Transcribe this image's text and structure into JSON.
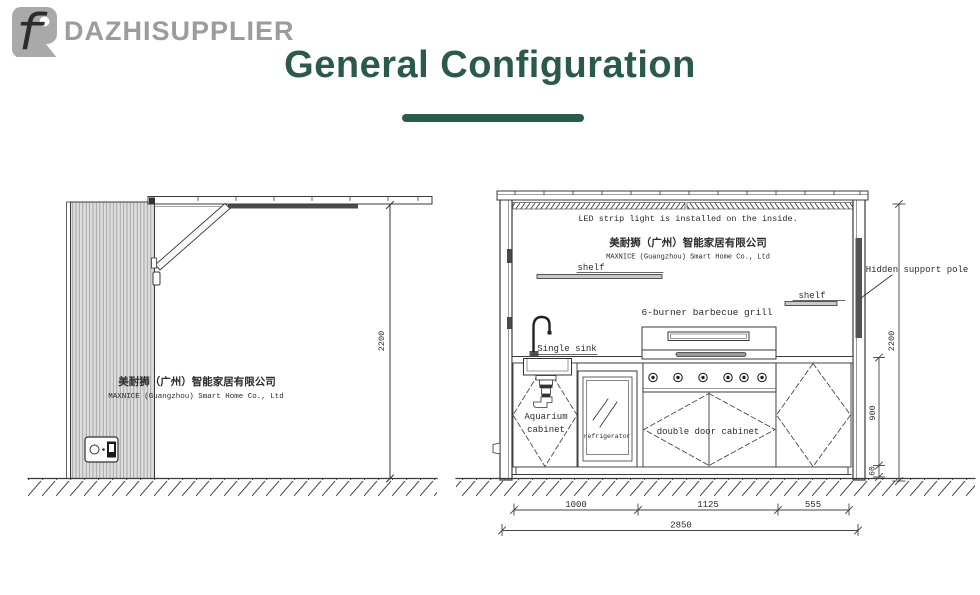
{
  "brand": {
    "name": "DAZHISUPPLIER",
    "monogram": "f"
  },
  "title": "General Configuration",
  "colors": {
    "accent_green": "#2a5b49",
    "logo_gray": "#9c9c9c",
    "line": "#3a3a3a"
  },
  "side_view": {
    "company_zh": "美耐狮（广州）智能家居有限公司",
    "company_en": "MAXNICE (Guangzhou) Smart Home Co., Ltd",
    "height_dim": "2200"
  },
  "front_view": {
    "led_note": "LED strip light is installed on the inside.",
    "company_zh": "美耐狮（广州）智能家居有限公司",
    "company_en": "MAXNICE (Guangzhou) Smart Home Co., Ltd",
    "shelf_left": "shelf",
    "shelf_right": "shelf",
    "grill_label": "6-burner barbecue grill",
    "sink_label": "Single sink",
    "aquarium_line1": "Aquarium",
    "aquarium_line2": "cabinet",
    "fridge_label": "refrigerator",
    "double_cabinet_label": "double door cabinet",
    "pole_label": "Hidden support pole",
    "dims": {
      "height": "2200",
      "cabinet_height": "900",
      "plinth": "60",
      "w1": "1000",
      "w2": "1125",
      "w3": "555",
      "total_width": "2850"
    }
  }
}
